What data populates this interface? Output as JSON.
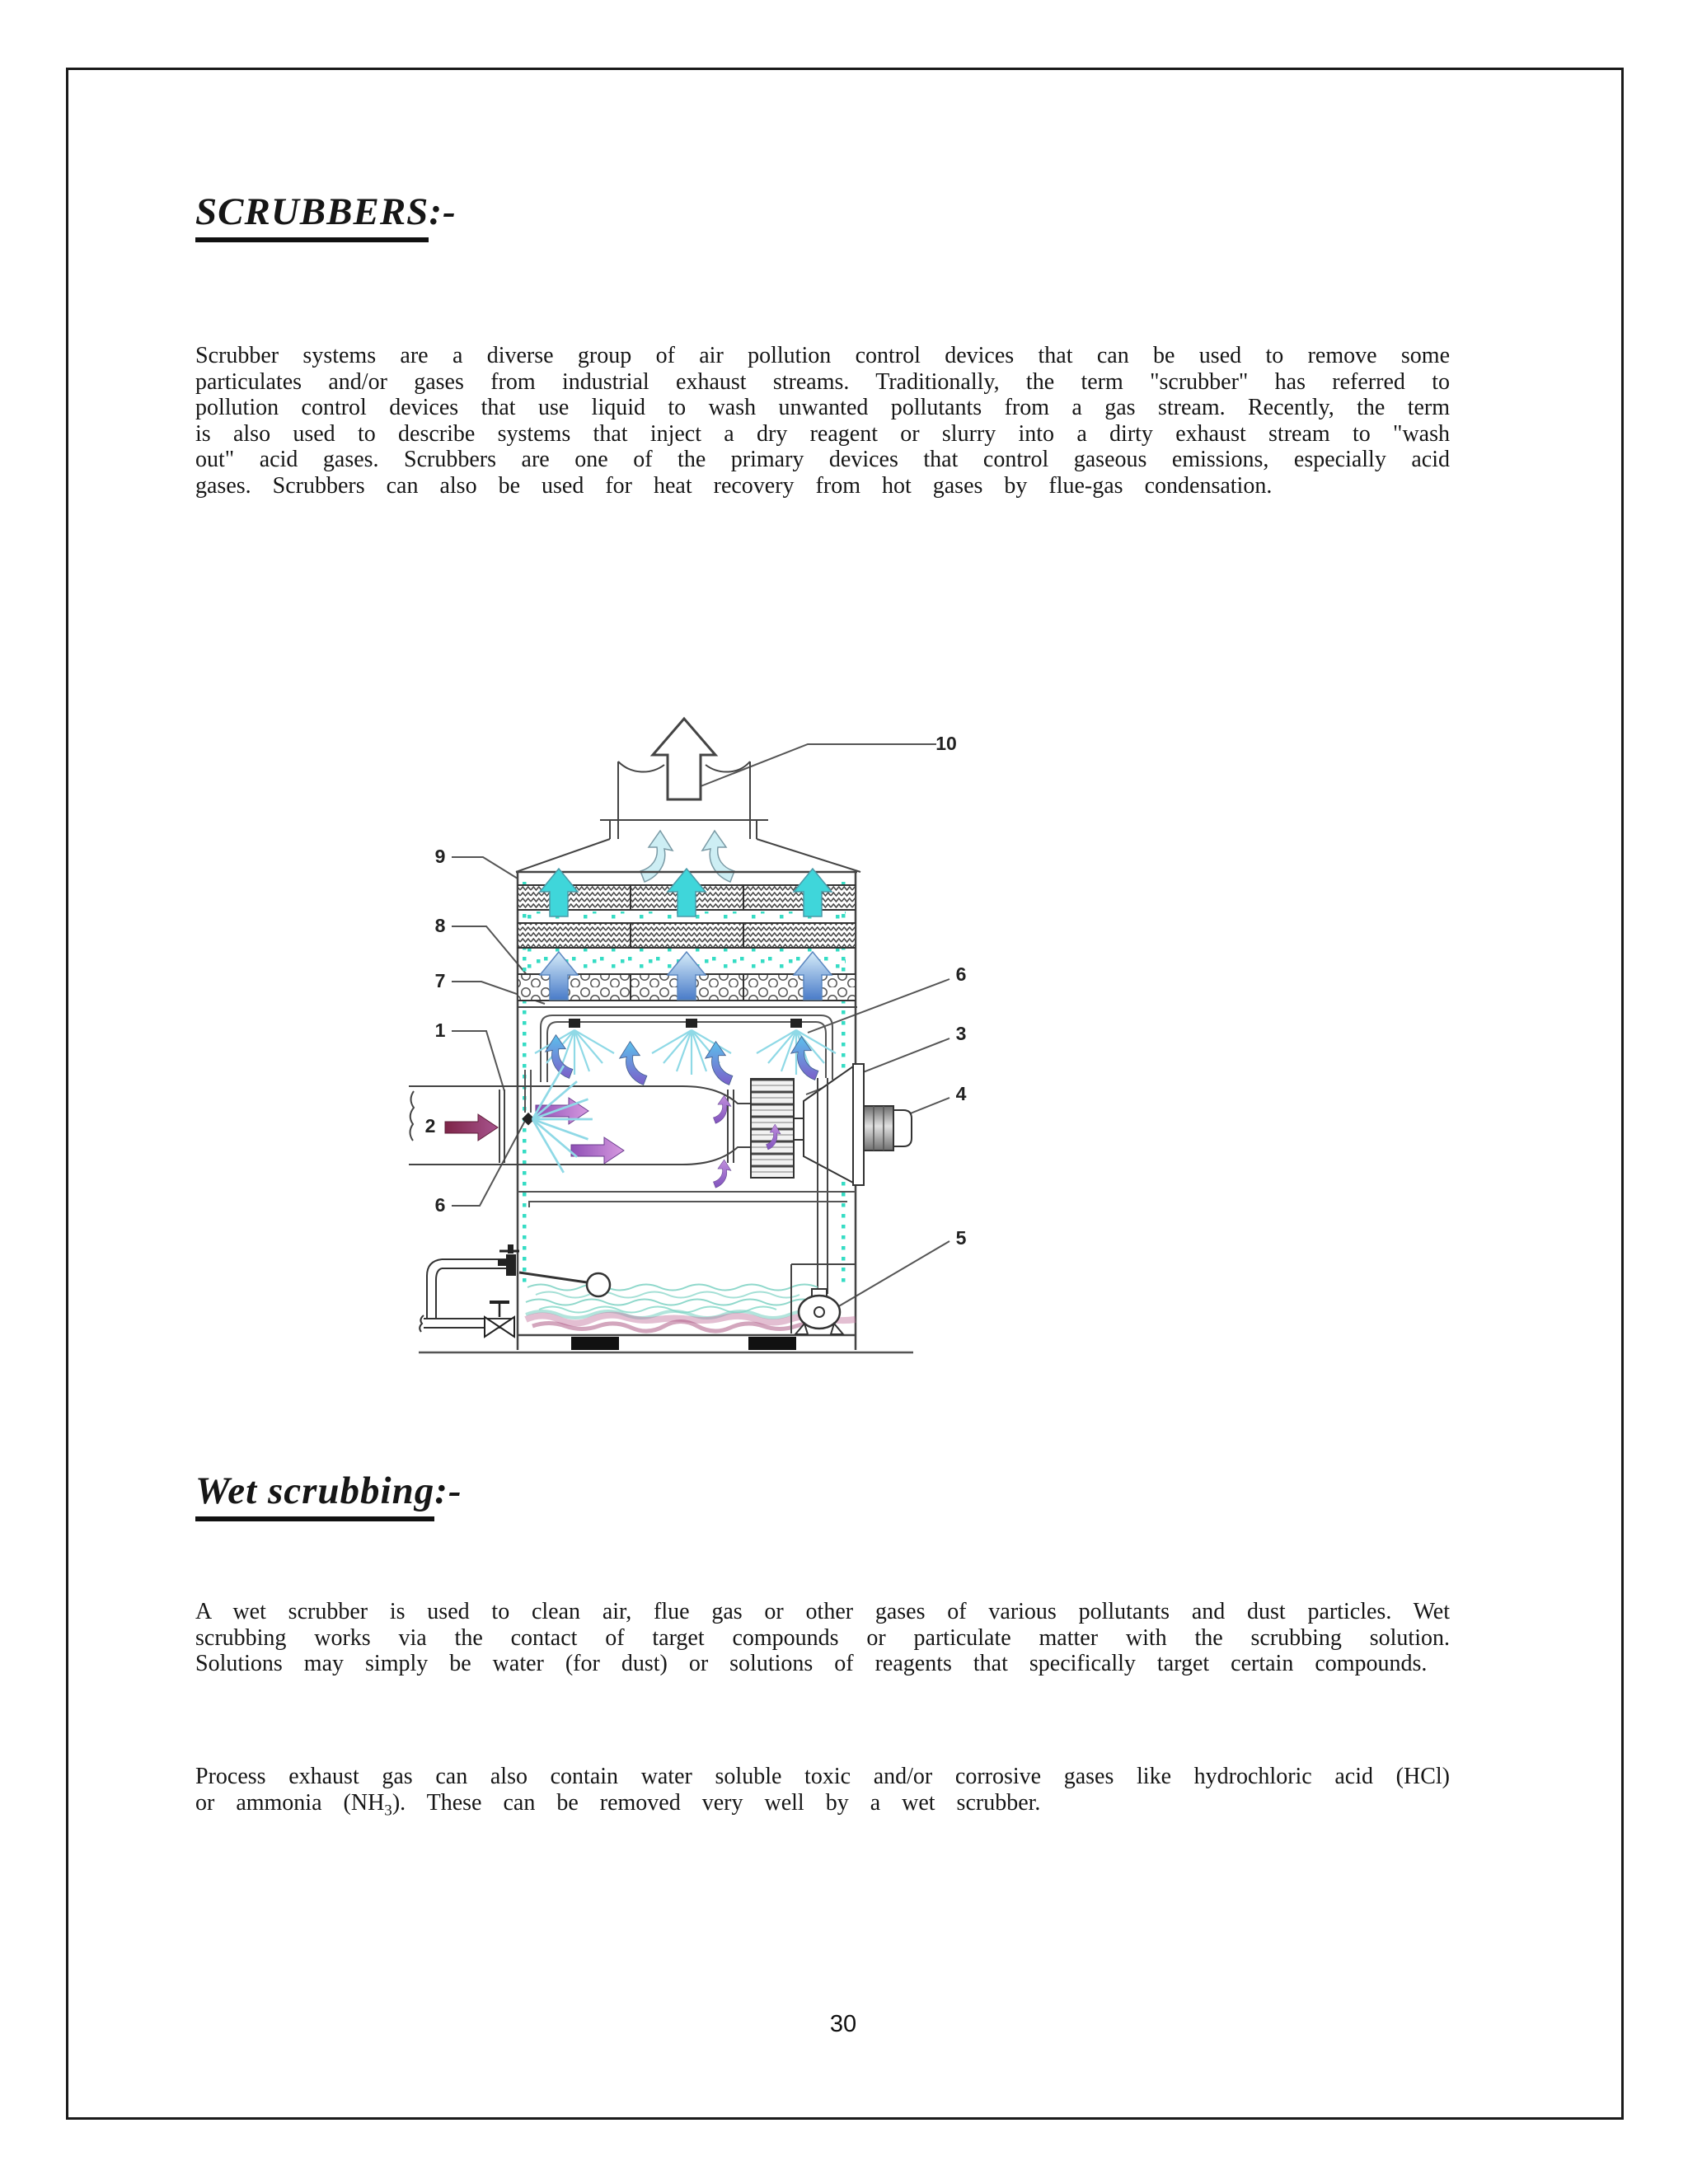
{
  "document": {
    "title": {
      "text": "SCRUBBERS",
      "suffix": ":-"
    },
    "intro_paragraph": "Scrubber systems are a diverse group of air pollution control devices that can be used to remove some particulates and/or gases from industrial exhaust streams. Traditionally, the term \"scrubber\" has referred to pollution control devices that use liquid to wash unwanted pollutants from a gas stream. Recently, the term is also used to describe systems that inject a dry reagent or slurry into a dirty exhaust stream to \"wash out\" acid gases. Scrubbers are one of the primary devices that control gaseous emissions, especially acid gases. Scrubbers can also be used for heat recovery from hot gases by flue-gas  condensation.",
    "section": {
      "title": "Wet scrubbing",
      "suffix": ":-"
    },
    "wet_paragraph": "A wet scrubber is used to clean air, flue gas or other gases of various pollutants and dust particles. Wet scrubbing works via the contact of target compounds or particulate matter with the scrubbing solution. Solutions may simply be water (for dust) or solutions of reagents that specifically target certain compounds.",
    "process_paragraph": {
      "part1": "Process exhaust gas can also contain water soluble toxic and/or corrosive gases like hydrochloric acid (HCl) or ammonia  (NH",
      "sub": "3",
      "part2": "). These can be removed very well by a wet scrubber."
    },
    "page_number": "30"
  },
  "diagram": {
    "description": "Wet scrubber system schematic with numbered parts",
    "callouts": {
      "c1": "1",
      "c2": "2",
      "c3": "3",
      "c4": "4",
      "c5": "5",
      "c6": "6",
      "c7": "7",
      "c8": "8",
      "c9": "9",
      "c10": "10"
    },
    "colors": {
      "outline": "#444444",
      "leader_line": "#555555",
      "cyan_arrow": "#3fd6da",
      "blue_arrow_top": "#d6ecf9",
      "blue_arrow_bottom": "#4a7cc9",
      "droplet": "#36dcc4",
      "spray": "#8fd9e6",
      "purple_arrow": "#8e4fb5",
      "inlet_arrow": "#7e2548",
      "swirl_blue": "#5cc0ec",
      "swirl_violet": "#7b5fc9",
      "hood_arrow": "#cdeef4",
      "water_wave": "#8fd8cb",
      "sludge": "#b85c8c",
      "motor_gray": "#8c8c8c"
    }
  }
}
